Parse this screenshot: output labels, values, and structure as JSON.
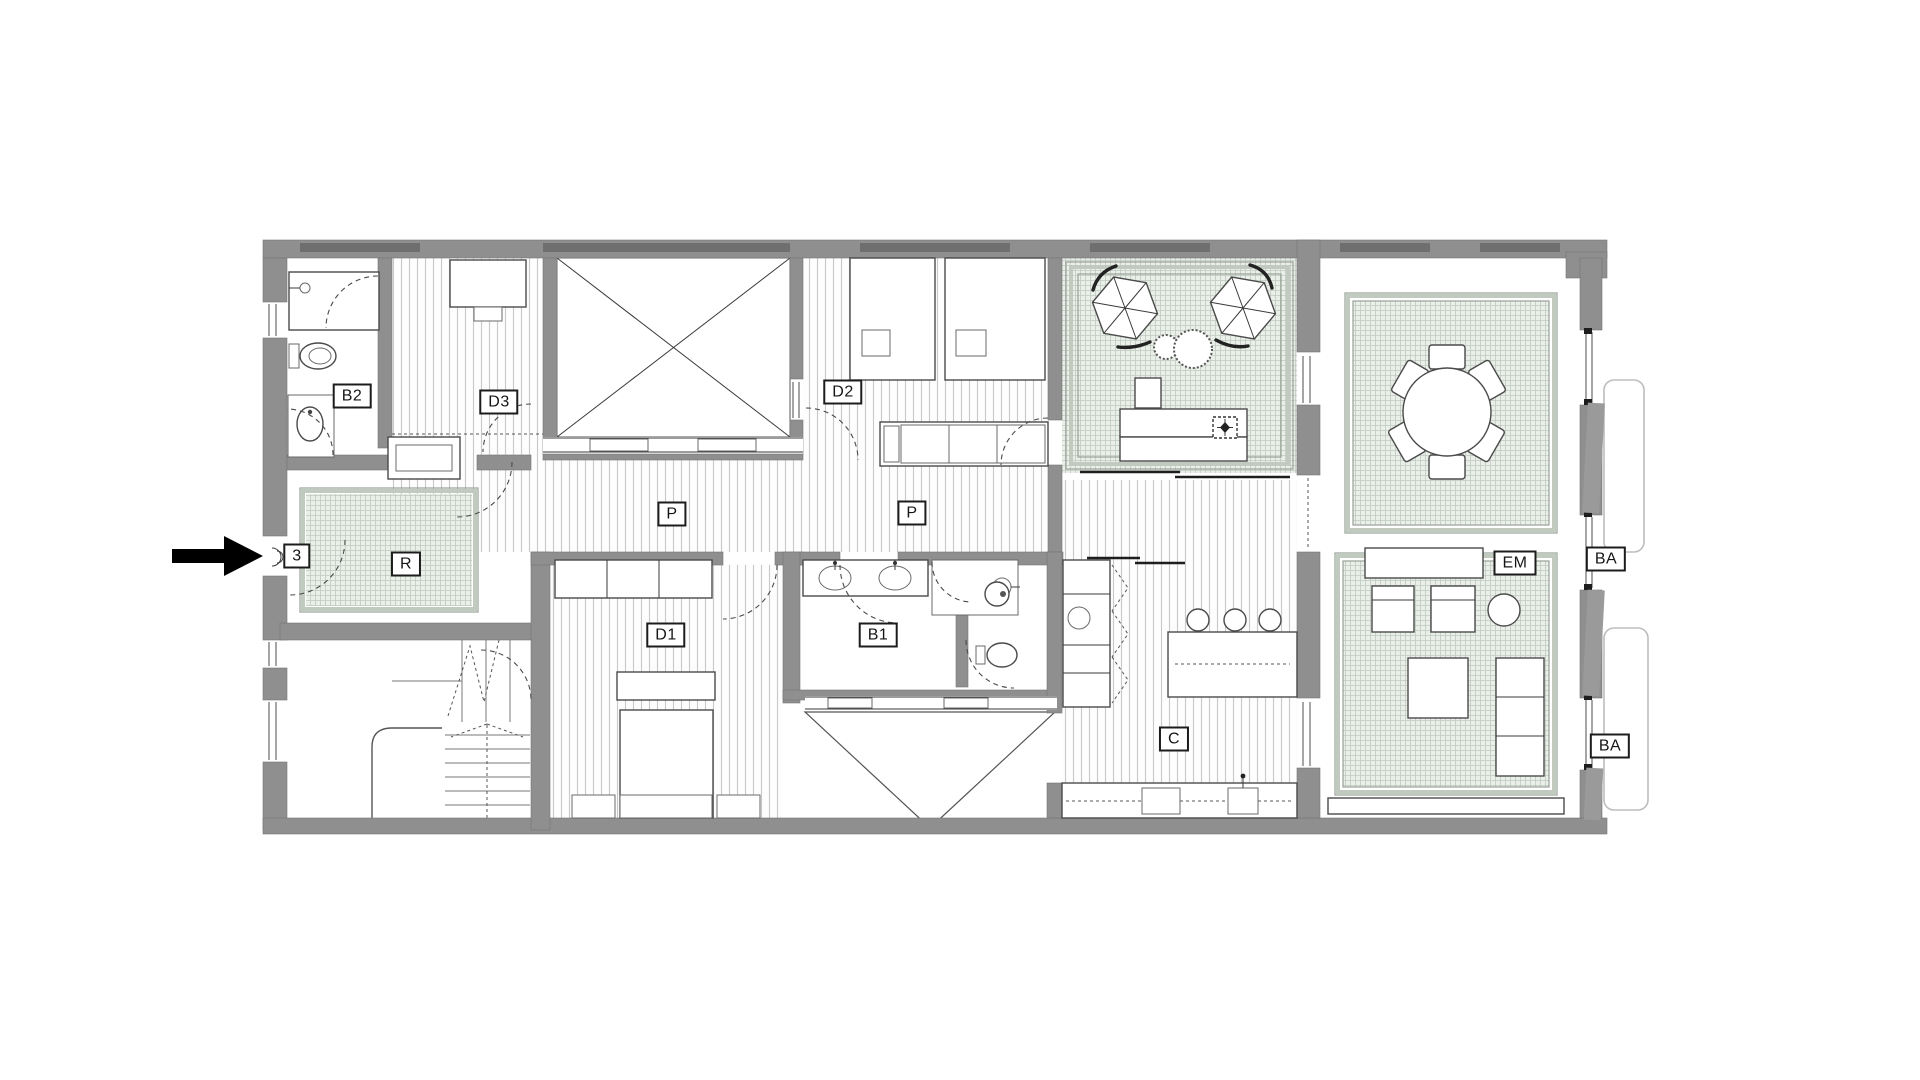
{
  "plan": {
    "title_hint": "apartment floor plan",
    "labels": [
      {
        "id": "b2",
        "text": "B2"
      },
      {
        "id": "d3",
        "text": "D3"
      },
      {
        "id": "d2",
        "text": "D2"
      },
      {
        "id": "p-left",
        "text": "P"
      },
      {
        "id": "p-right",
        "text": "P"
      },
      {
        "id": "entry-num",
        "text": "3"
      },
      {
        "id": "r",
        "text": "R"
      },
      {
        "id": "d1",
        "text": "D1"
      },
      {
        "id": "b1",
        "text": "B1"
      },
      {
        "id": "c",
        "text": "C"
      },
      {
        "id": "em",
        "text": "EM"
      },
      {
        "id": "ba-upper",
        "text": "BA"
      },
      {
        "id": "ba-lower",
        "text": "BA"
      }
    ],
    "symbols": {
      "entry_arrow": "black-arrow-pointing-right-at-entry-door",
      "void_marks": "crossed-X-lightwell and V-triangle-void",
      "terrace_items": "two-parasols, two-round-tables, planter-with-star-symbol"
    },
    "colors": {
      "wall": "#8f8f8f",
      "wall-dark": "#6f6f6f",
      "wall-stroke": "#767676",
      "line": "#3a3a3a",
      "stripe": "#c9c9c9",
      "rug-fill": "#eaefe9",
      "rug-line": "#c0cabf",
      "arrow": "#000000",
      "label-border": "#1c1c1c"
    }
  }
}
